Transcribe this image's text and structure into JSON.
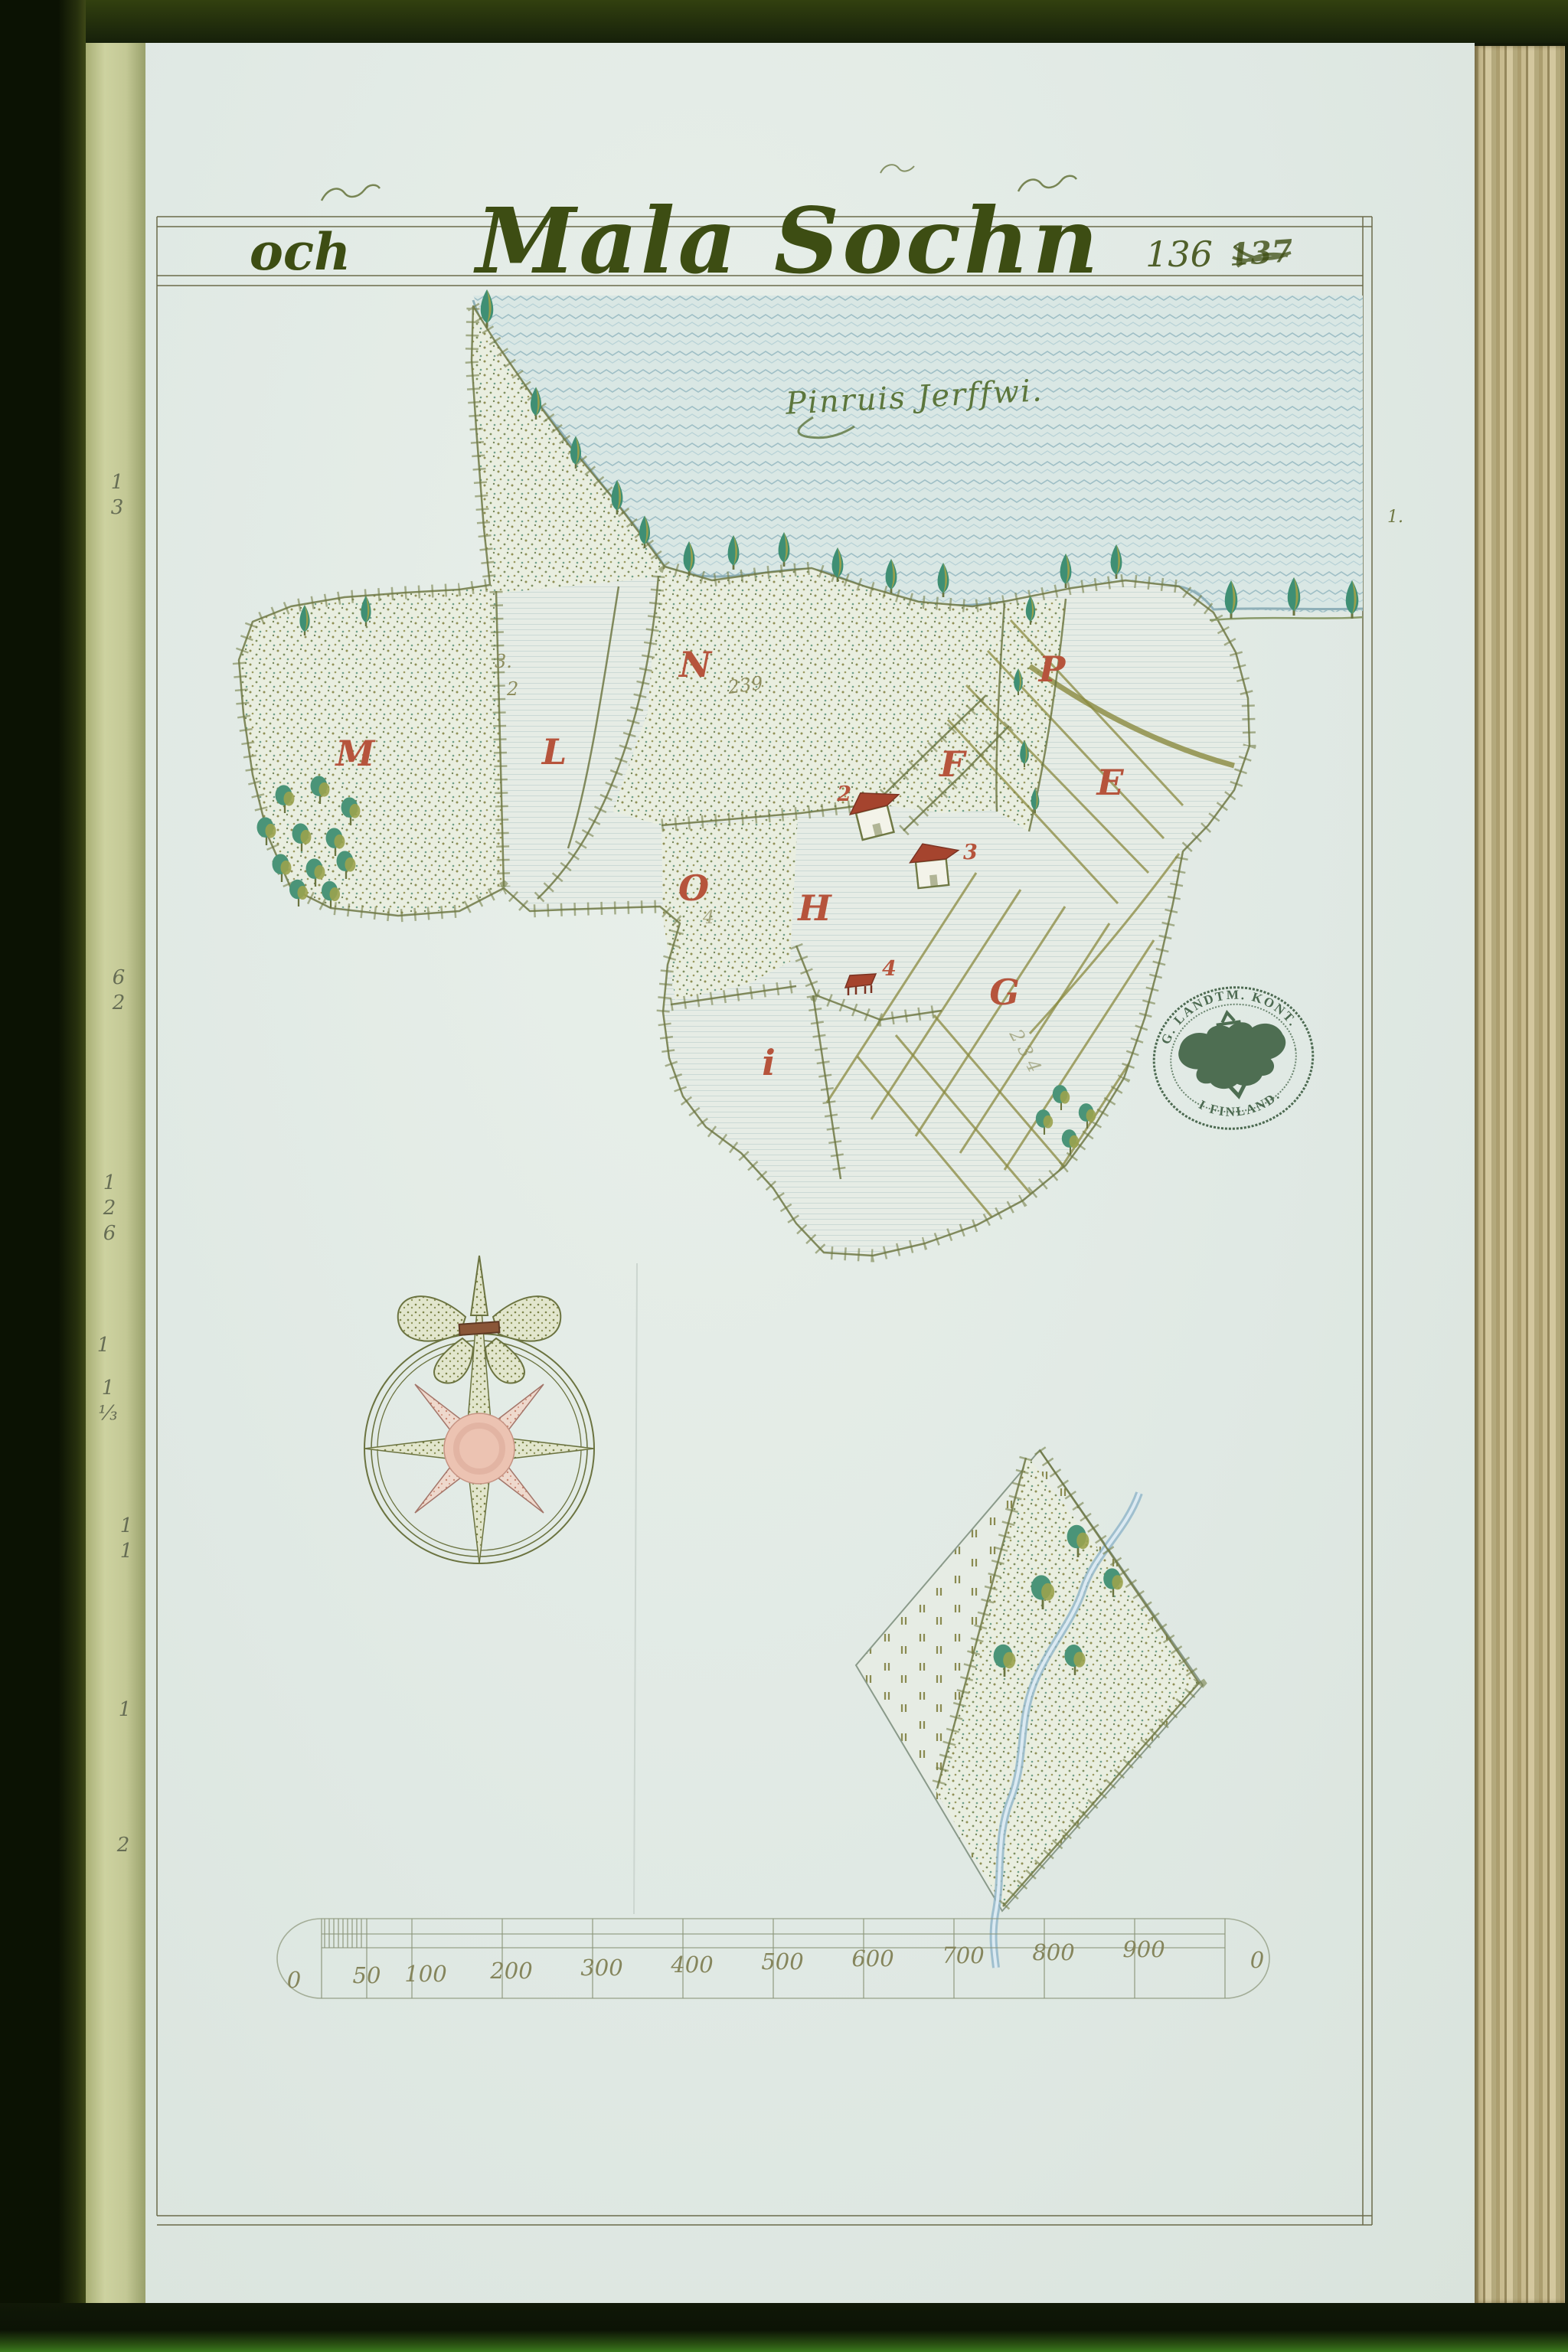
{
  "map": {
    "title_prefix": "och",
    "title_main": "Mala Sochn",
    "page_number": "136",
    "struck_number": "137",
    "frame_note": "1.",
    "water_label": "Pinruis Jerffwi."
  },
  "parcels": {
    "M": "M",
    "L": "L",
    "N": "N",
    "O": "O",
    "H": "H",
    "P": "P",
    "F": "F",
    "E": "E",
    "G": "G",
    "I": "i",
    "Q": "Q",
    "S": "S"
  },
  "numbers": {
    "n_field": "239",
    "l_field_a": "3.",
    "l_field_b": "2",
    "o_field": "4",
    "g_field": "234",
    "q_field": "5",
    "house_a": "2",
    "house_b": "3",
    "barn": "4"
  },
  "seal": {
    "arc_top": "G. LANDTM. KONT.",
    "arc_bottom": "I FINLAND."
  },
  "scale_bar": {
    "zero_left": "0",
    "zero_right": "0",
    "labels": [
      "50",
      "100",
      "200",
      "300",
      "400",
      "500",
      "600",
      "700",
      "800",
      "900"
    ]
  },
  "book": {
    "margin_numbers": [
      "13",
      "62",
      "126",
      "1",
      "1⅓",
      "11",
      "1",
      "2"
    ]
  },
  "colors": {
    "ink_olive": "#6f7844",
    "letter_red": "#b6543c",
    "water_blue": "#9fbfc6",
    "paper": "#e2eae6",
    "seal_green": "#3c5c40"
  }
}
